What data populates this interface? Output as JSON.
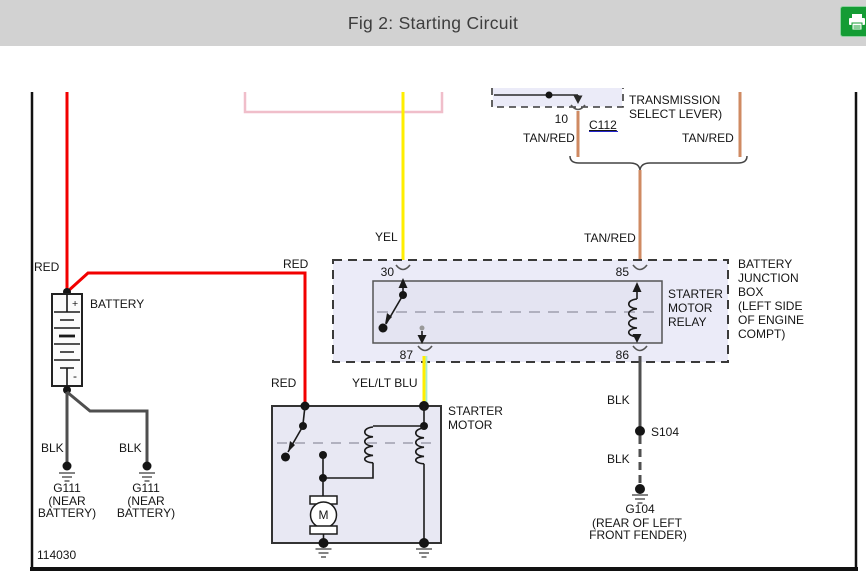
{
  "header": {
    "title": "Fig 2: Starting Circuit"
  },
  "toolbar": {
    "print_icon": "printer-icon"
  },
  "colors": {
    "header_bg": "#d2d2d2",
    "title_text": "#3d3d3d",
    "print_green": "#149c34",
    "red": "#f20000",
    "yellow": "#ffee00",
    "tan_red": "#cf8a62",
    "black_wire": "#4f4f4f",
    "lt_blu": "#a9ecc9",
    "pink": "#f0beca",
    "navy": "#1f3a6e",
    "purple": "#7c2b8d",
    "link_blue": "#2424cd",
    "box_fill": "#ebebf8",
    "inner_fill": "#e4e4f2",
    "motor_box_fill": "#e8e8f3"
  },
  "wires": {
    "red_label_left": "RED",
    "red_label_top": "RED",
    "red_label_starter": "RED",
    "yel_label": "YEL",
    "yel_lt_blu_label": "YEL/LT BLU",
    "tan_red_label_left": "TAN/RED",
    "tan_red_label_right": "TAN/RED",
    "tan_red_label_center": "TAN/RED",
    "blk_label_g111_left": "BLK",
    "blk_label_g111_right": "BLK",
    "blk_label_upper": "BLK",
    "blk_label_lower": "BLK"
  },
  "battery": {
    "label": "BATTERY",
    "plus": "+",
    "minus": "-"
  },
  "transmission": {
    "line1": "TRANSMISSION",
    "line2": "SELECT LEVER)",
    "pin": "10",
    "connector": "C112"
  },
  "relay": {
    "pin30": "30",
    "pin85": "85",
    "pin87": "87",
    "pin86": "86",
    "name1": "STARTER",
    "name2": "MOTOR",
    "name3": "RELAY"
  },
  "junction_box": {
    "line1": "BATTERY",
    "line2": "JUNCTION",
    "line3": "BOX",
    "line4": "(LEFT SIDE",
    "line5": "OF ENGINE",
    "line6": "COMPT)"
  },
  "starter_motor": {
    "name1": "STARTER",
    "name2": "MOTOR",
    "motor_letter": "M"
  },
  "grounds": {
    "g111_left": {
      "id": "G111",
      "loc1": "(NEAR",
      "loc2": "BATTERY)"
    },
    "g111_right": {
      "id": "G111",
      "loc1": "(NEAR",
      "loc2": "BATTERY)"
    },
    "s104": {
      "id": "S104"
    },
    "g104": {
      "id": "G104",
      "loc1": "(REAR OF LEFT",
      "loc2": "FRONT FENDER)"
    }
  },
  "figure_number": "114030"
}
